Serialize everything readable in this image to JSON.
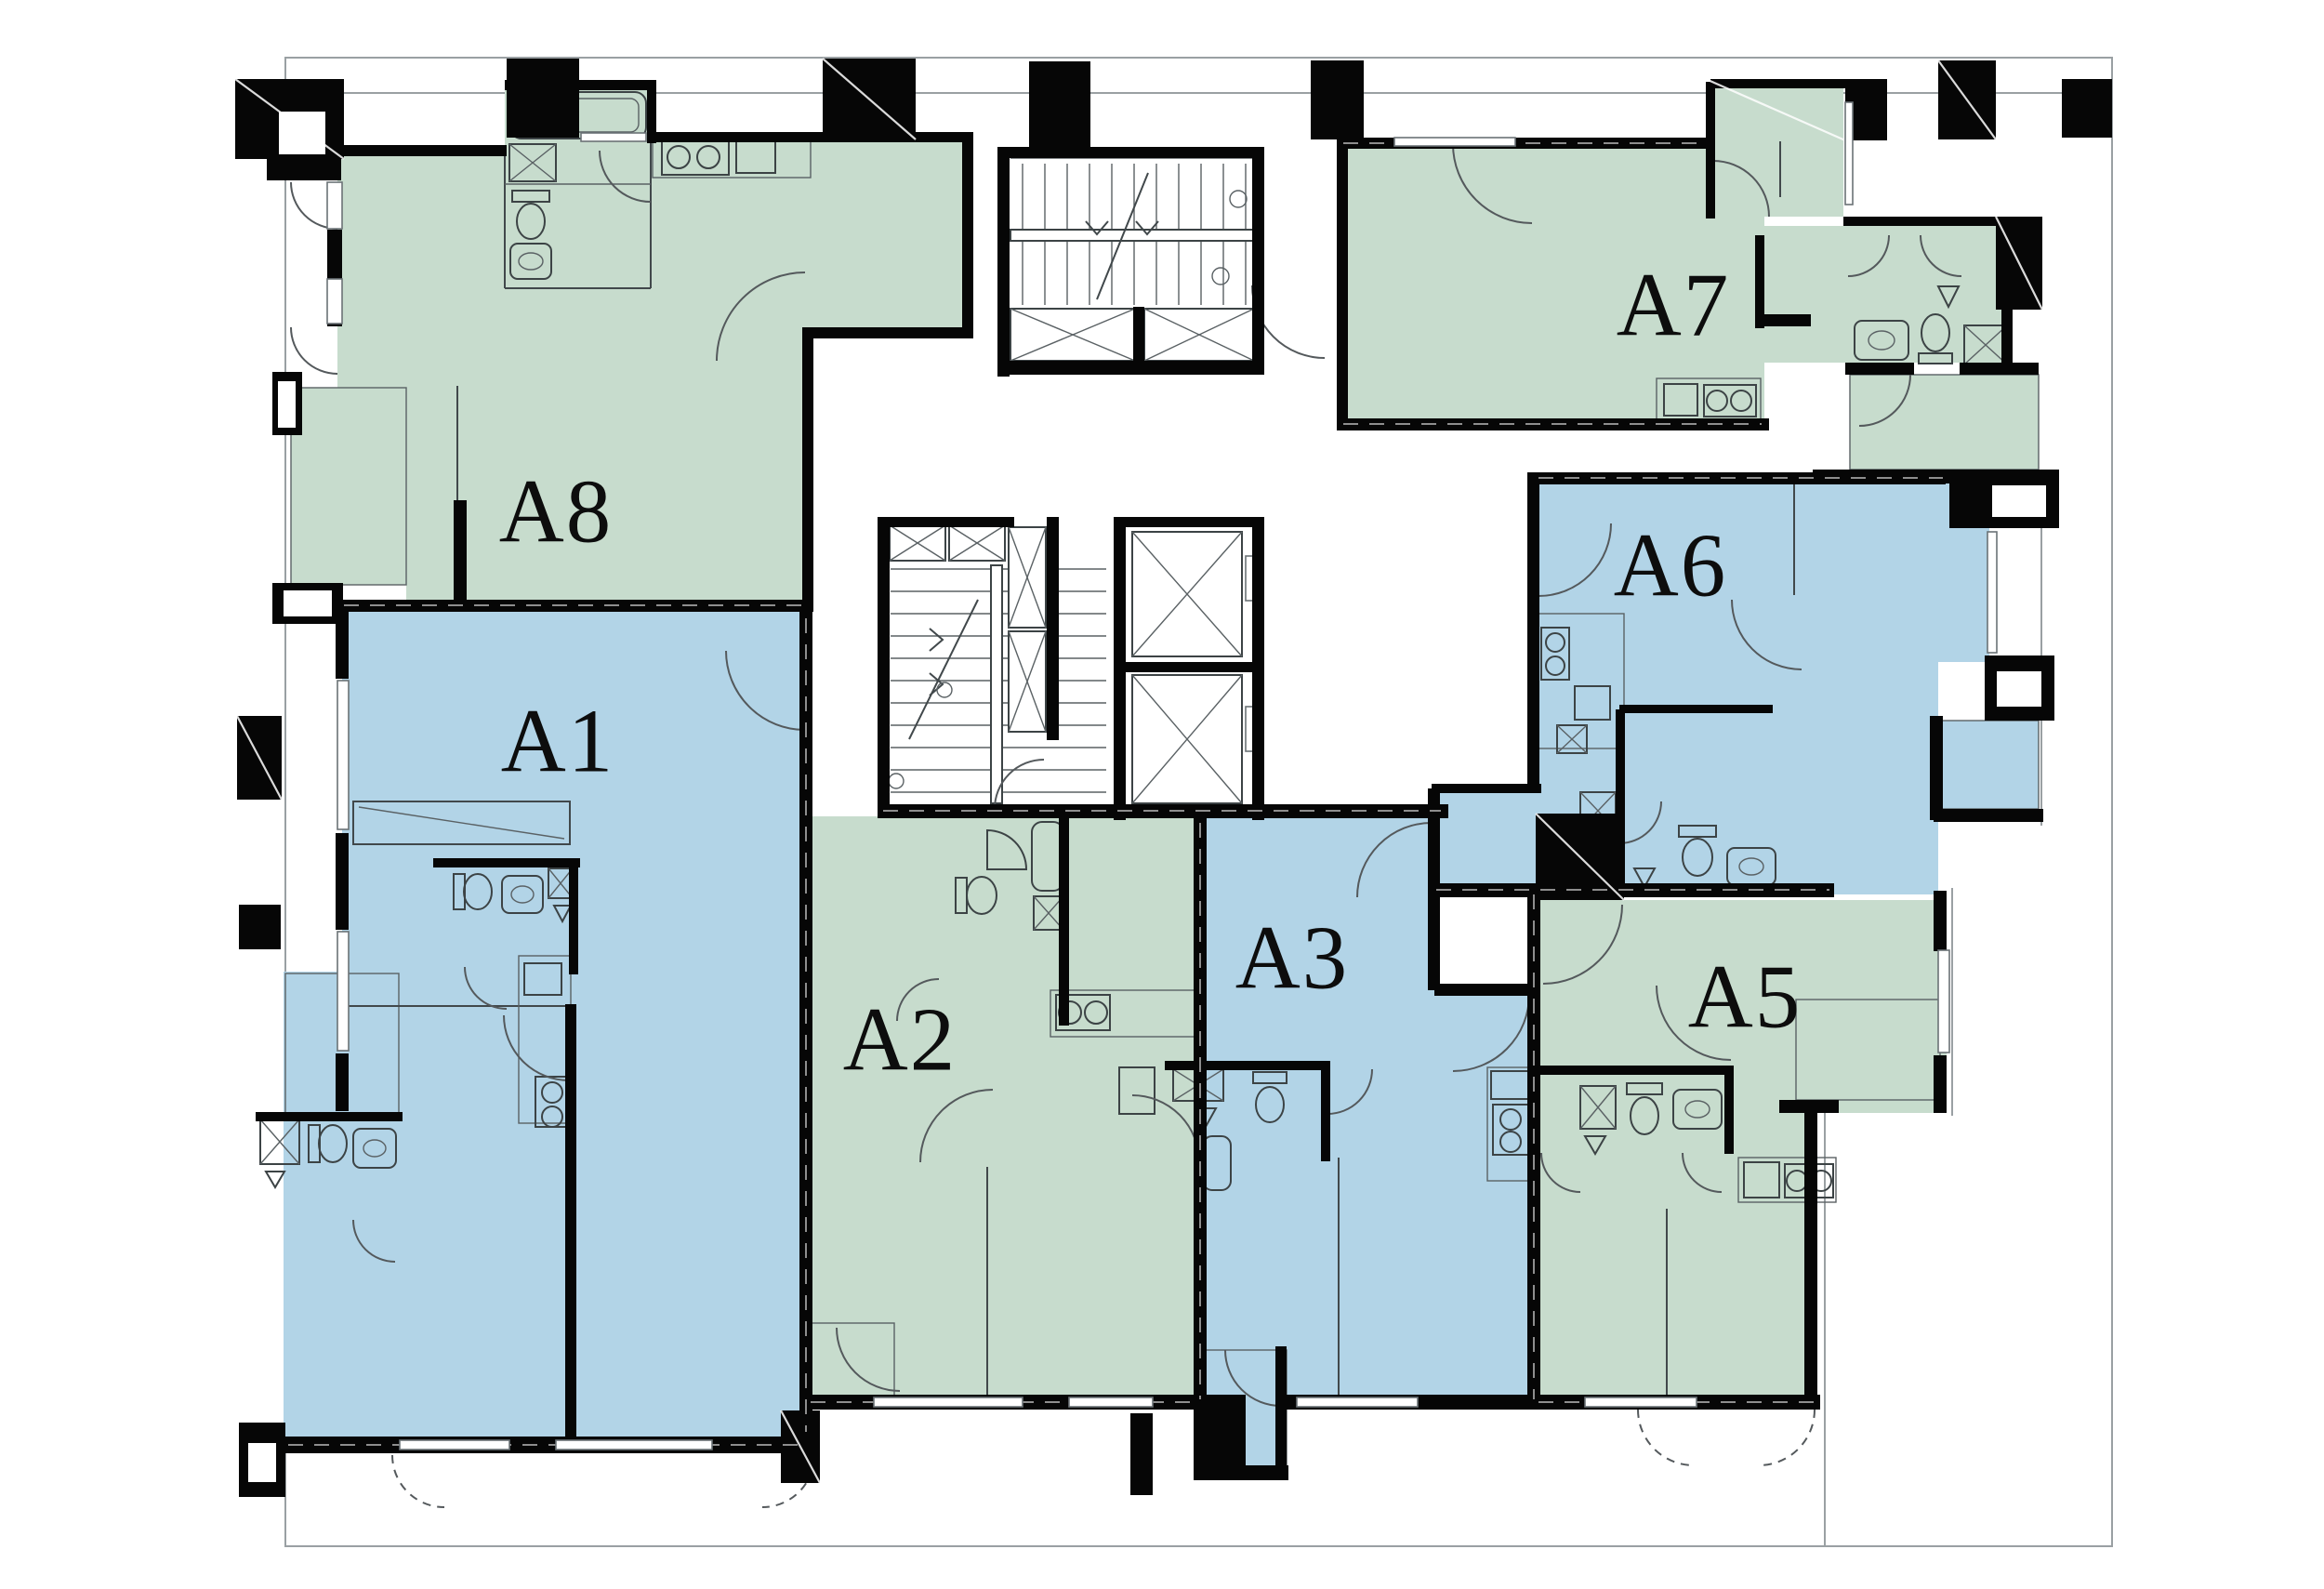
{
  "plan": {
    "type": "residential-floor-plan",
    "units": [
      {
        "id": "a1",
        "label": "A1",
        "color_key": "unit_blue"
      },
      {
        "id": "a2",
        "label": "A2",
        "color_key": "unit_green"
      },
      {
        "id": "a3",
        "label": "A3",
        "color_key": "unit_blue"
      },
      {
        "id": "a5",
        "label": "A5",
        "color_key": "unit_green"
      },
      {
        "id": "a6",
        "label": "A6",
        "color_key": "unit_blue"
      },
      {
        "id": "a7",
        "label": "A7",
        "color_key": "unit_green"
      },
      {
        "id": "a8",
        "label": "A8",
        "color_key": "unit_green"
      }
    ],
    "core": {
      "elevator_shafts": 2,
      "stairwells": 2,
      "vent_shafts": 4
    }
  },
  "colors": {
    "unit_green": "#c7dccd",
    "unit_blue": "#b2d4e7",
    "wall_black": "#060606",
    "background": "#ffffff"
  }
}
